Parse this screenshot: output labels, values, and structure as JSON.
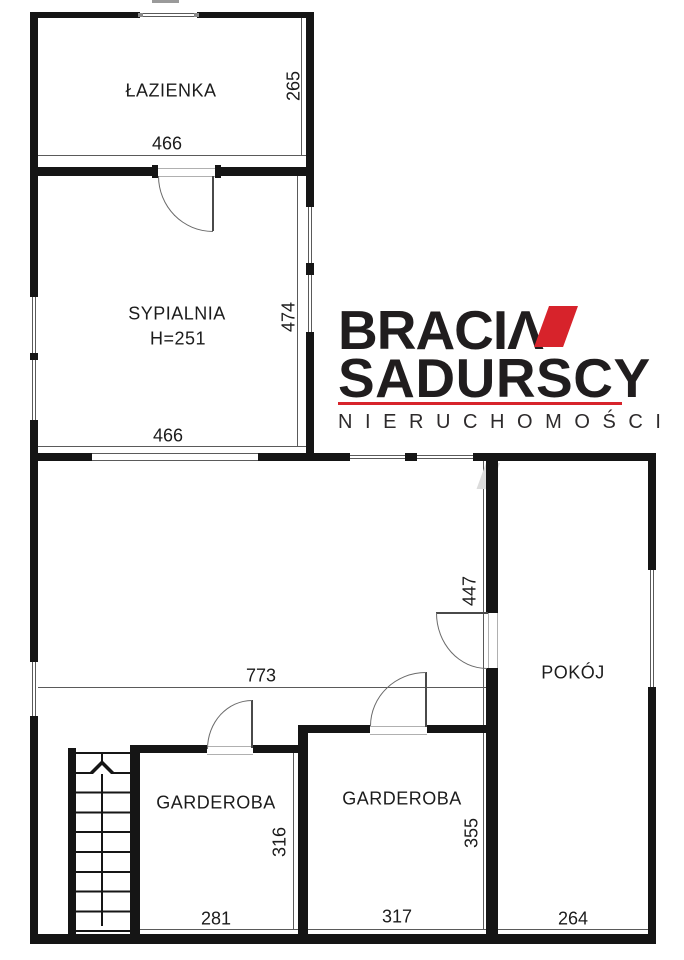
{
  "labels": {
    "lazienka": "ŁAZIENKA",
    "sypialnia": "SYPIALNIA",
    "sypialnia_height": "H=251",
    "pokoj": "POKÓJ",
    "garderoba_left": "GARDEROBA",
    "garderoba_middle": "GARDEROBA"
  },
  "dims": {
    "lazienka_width": "466",
    "lazienka_depth": "265",
    "sypialnia_width": "466",
    "sypialnia_depth": "474",
    "hall_width": "773",
    "hall_depth": "447",
    "garderoba_left_width": "281",
    "garderoba_left_depth": "316",
    "garderoba_middle_width": "317",
    "garderoba_middle_depth": "355",
    "pokoj_width": "264"
  },
  "logo": {
    "brand_top": "BRACI",
    "brand_top_glyph": "Λ",
    "brand_bottom": "SADURSCY",
    "tagline": "N I E R U C H O M O Ś C I",
    "accent_red": "#d7232b",
    "ink": "#201d1e"
  }
}
